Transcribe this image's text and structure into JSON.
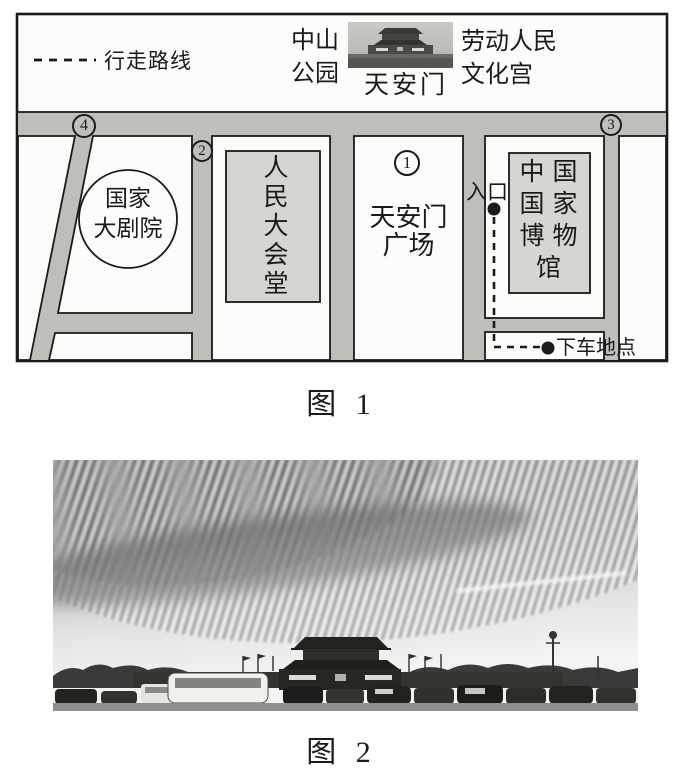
{
  "colors": {
    "ink": "#1a1a1a",
    "road_gray": "#bfbfba",
    "building_gray": "#d6d6d1",
    "paper": "#fcfcfa"
  },
  "figure1": {
    "caption": "图 1",
    "legend_label": "行走路线",
    "top_labels": {
      "zhongshan_line1": "中山",
      "zhongshan_line2": "公园",
      "tiananmen": "天安门",
      "palace_line1": "劳动人民",
      "palace_line2": "文化宫"
    },
    "numbers": {
      "n1": "1",
      "n2": "2",
      "n3": "3",
      "n4": "4"
    },
    "places": {
      "theatre_line1": "国家",
      "theatre_line2": "大剧院",
      "great_hall": "人民大会堂",
      "square_line1": "天安门",
      "square_line2": "广场",
      "museum_lines": [
        "中国",
        "国家",
        "博物",
        "馆"
      ],
      "entrance": "入口",
      "dropoff": "下车地点"
    }
  },
  "figure2": {
    "caption": "图 2"
  }
}
